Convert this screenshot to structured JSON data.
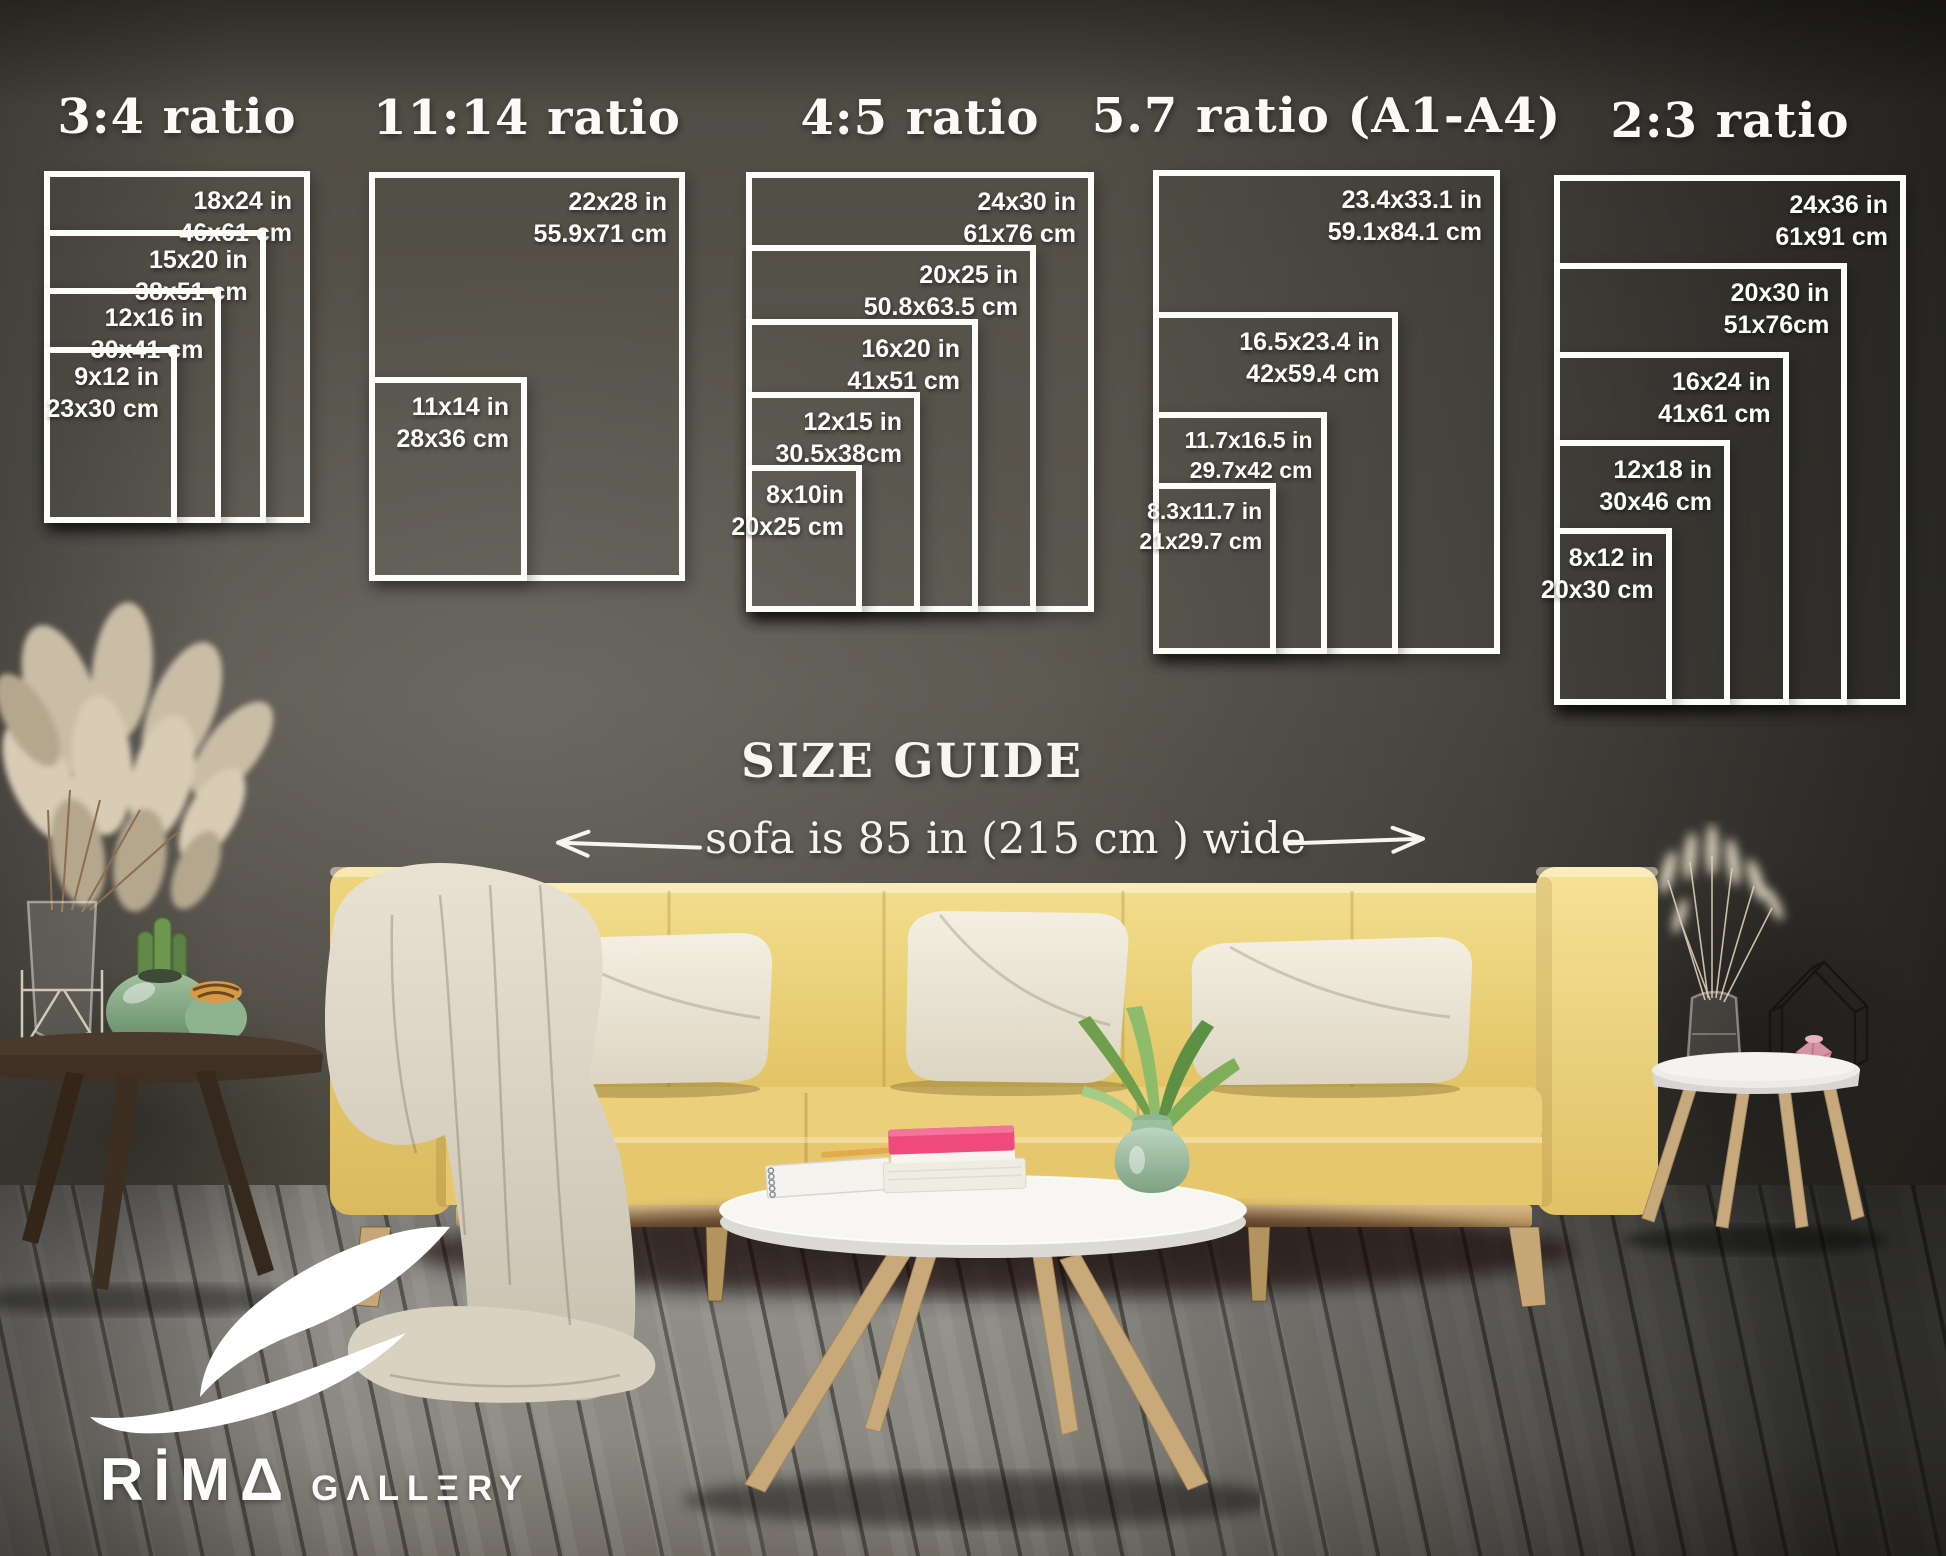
{
  "size_guide": {
    "heading": "SIZE GUIDE",
    "sofa_note": "sofa is 85 in (215 cm ) wide",
    "groups": [
      {
        "title": "3:4 ratio",
        "sizes": [
          {
            "inch": "18x24 in",
            "cm": "46x61 cm"
          },
          {
            "inch": "15x20 in",
            "cm": "38x51 cm"
          },
          {
            "inch": "12x16 in",
            "cm": "30x41 cm"
          },
          {
            "inch": "9x12 in",
            "cm": "23x30 cm"
          }
        ]
      },
      {
        "title": "11:14 ratio",
        "sizes": [
          {
            "inch": "22x28 in",
            "cm": "55.9x71 cm"
          },
          {
            "inch": "11x14 in",
            "cm": "28x36 cm"
          }
        ]
      },
      {
        "title": "4:5 ratio",
        "sizes": [
          {
            "inch": "24x30 in",
            "cm": "61x76 cm"
          },
          {
            "inch": "20x25 in",
            "cm": "50.8x63.5 cm"
          },
          {
            "inch": "16x20 in",
            "cm": "41x51 cm"
          },
          {
            "inch": "12x15 in",
            "cm": "30.5x38cm"
          },
          {
            "inch": "8x10in",
            "cm": "20x25 cm"
          }
        ]
      },
      {
        "title": "5.7 ratio (A1-A4)",
        "sizes": [
          {
            "inch": "23.4x33.1 in",
            "cm": "59.1x84.1 cm"
          },
          {
            "inch": "16.5x23.4 in",
            "cm": "42x59.4 cm"
          },
          {
            "inch": "11.7x16.5 in",
            "cm": "29.7x42 cm"
          },
          {
            "inch": "8.3x11.7 in",
            "cm": "21x29.7 cm"
          }
        ]
      },
      {
        "title": "2:3 ratio",
        "sizes": [
          {
            "inch": "24x36 in",
            "cm": "61x91 cm"
          },
          {
            "inch": "20x30 in",
            "cm": "51x76cm"
          },
          {
            "inch": "16x24 in",
            "cm": "41x61 cm"
          },
          {
            "inch": "12x18 in",
            "cm": "30x46 cm"
          },
          {
            "inch": "8x12 in",
            "cm": "20x30 cm"
          }
        ]
      }
    ]
  },
  "logo": {
    "brand": "RİMΔ",
    "suffix": "GΛLLΞRY"
  },
  "palette": {
    "wall_gray": "#56534b",
    "floor_gray": "#8b8981",
    "sofa_yellow": "#e9cc74",
    "pillow_cream": "#f0ebdd",
    "book_pink": "#ee4b7c",
    "vase_green": "#a6c7ab",
    "overlay_white": "#fcfcf9"
  }
}
